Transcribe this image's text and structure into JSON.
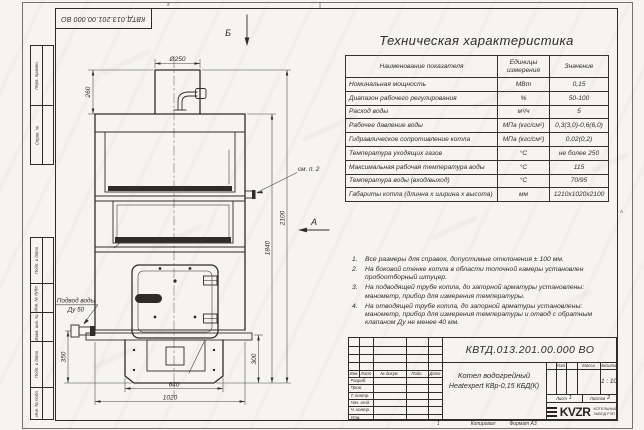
{
  "sheet": {
    "doc_number_top": "КВТД.013.201.00.000 ВО",
    "zone_top": "2",
    "zone_right": "А",
    "margin_labels": [
      "Перв. примен.",
      "Справ. №",
      "Подп. и дата",
      "Инв. № дубл.",
      "Взам. инв. №",
      "Подп. и дата",
      "Инв. № подл."
    ],
    "footer": {
      "fold_mark": "1",
      "copy_label": "Копировал",
      "format_label": "Формат А3"
    }
  },
  "drawing": {
    "view_arrow_top": "Б",
    "view_arrow_side": "А",
    "callout_note": "см. п. 2",
    "water_supply_line1": "Подвод воды",
    "water_supply_line2": "Ду 50",
    "dim_chimney_dia": "Ø250",
    "dim_chimney_h": "260",
    "dim_body_h": "1840",
    "dim_total_h": "2100",
    "dim_base_w": "640",
    "dim_total_w": "1020",
    "dim_inlet_h": "350",
    "dim_base_h": "300"
  },
  "spec_table": {
    "title": "Техническая характеристика",
    "col_name": "Наименование показателя",
    "col_units": "Единицы измерения",
    "col_value": "Значение",
    "rows": [
      {
        "name": "Номинальная мощность",
        "units": "МВт",
        "value": "0,15"
      },
      {
        "name": "Диапазон рабочего регулирования",
        "units": "%",
        "value": "50-100"
      },
      {
        "name": "Расход воды",
        "units": "м³/ч",
        "value": "5"
      },
      {
        "name": "Рабочее давление воды",
        "units": "МПа (кгс/см²)",
        "value": "0,3(3,0)-0,6(6,0)"
      },
      {
        "name": "Гидравлическое сопротивление котла",
        "units": "МПа (кгс/см²)",
        "value": "0,02(0,2)"
      },
      {
        "name": "Температура уходящих газов",
        "units": "°С",
        "value": "не более 250"
      },
      {
        "name": "Максимальная рабочая температура воды",
        "units": "°С",
        "value": "115"
      },
      {
        "name": "Температура воды (вход/выход)",
        "units": "°С",
        "value": "70/95"
      },
      {
        "name": "Габариты котла (длинна х ширина х высота)",
        "units": "мм",
        "value": "1210х1020х2100"
      }
    ]
  },
  "notes": {
    "items": [
      "Все размеры для справок, допустимые отклонения ± 100 мм.",
      "На боковой стенке котла в области топочной камеры установлен пробоотборный штуцер.",
      "На подводящей трубе котла, до запорной арматуры установлены: манометр, прибор для измерения температуры.",
      "На отводящей трубе котла, до запорной арматуры установлены: манометр, прибор для измерения температуры и отвод с обратным клапаном Ду не менее 40 мм."
    ]
  },
  "title_block": {
    "doc_number": "КВТД.013.201.00.000 ВО",
    "product_line1": "Котел водогрейный",
    "product_line2": "Heatexpert КВр-0,15 КБД(К)",
    "header_cols": {
      "izm": "Изм.",
      "list": "Лист",
      "doc": "№ докум.",
      "podp": "Подп.",
      "data": "Дата"
    },
    "sign_rows": [
      "Разраб.",
      "Пров.",
      "Т. контр.",
      "Нач. отд.",
      "Н. контр.",
      "Утв."
    ],
    "lit_label": "Лит.",
    "mass_label": "Масса",
    "scale_label": "Масштаб",
    "scale_value": "1 : 10",
    "sheet_label": "Лист",
    "sheet_value": "1",
    "sheets_label": "Листов",
    "sheets_value": "2",
    "logo_text": "KVZR",
    "logo_sub1": "КОТЕЛЬНЫЙ",
    "logo_sub2": "ЗАВОД РЭП"
  }
}
